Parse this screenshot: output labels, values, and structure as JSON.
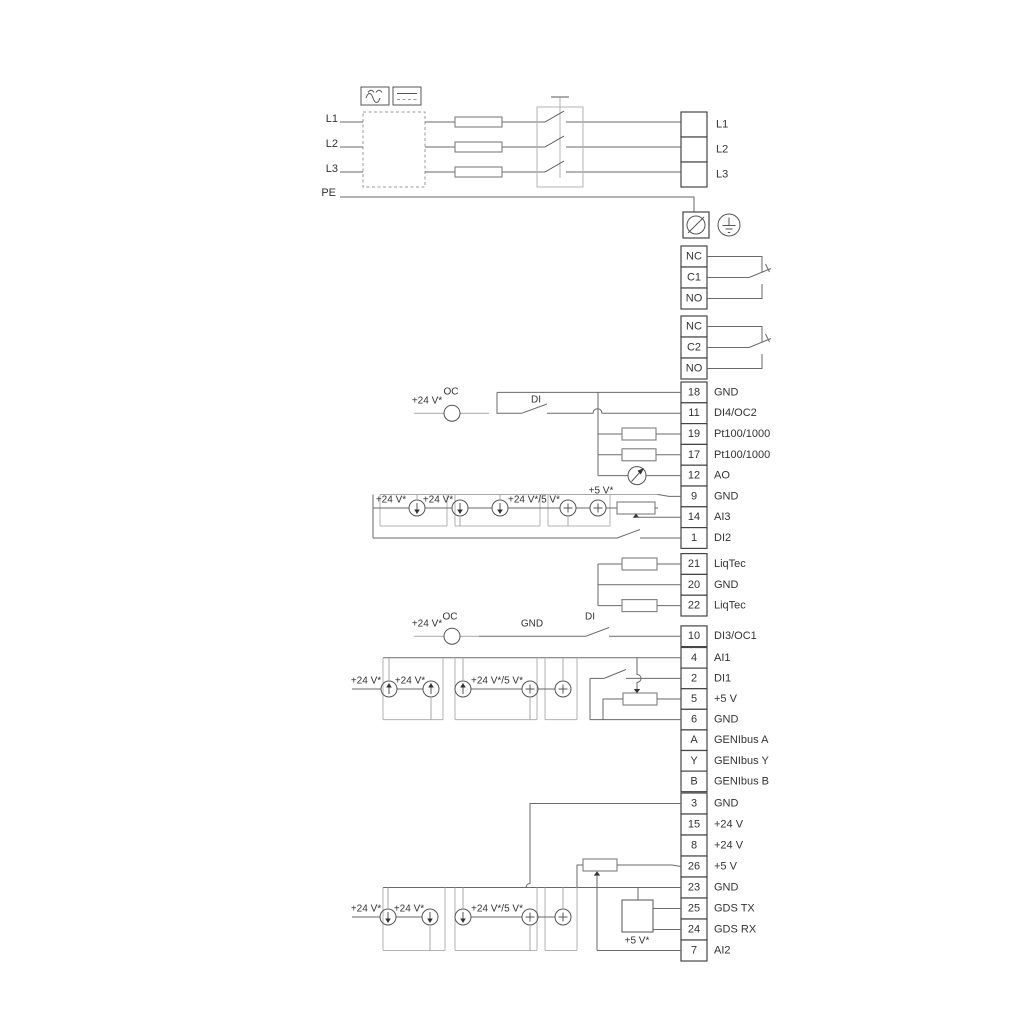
{
  "power": {
    "in": [
      "L1",
      "L2",
      "L3"
    ],
    "pe": "PE",
    "out": [
      "L1",
      "L2",
      "L3"
    ]
  },
  "relays": {
    "r1": [
      "NC",
      "C1",
      "NO"
    ],
    "r2": [
      "NC",
      "C2",
      "NO"
    ]
  },
  "terminals": {
    "io1": [
      {
        "n": "18",
        "l": "GND"
      },
      {
        "n": "11",
        "l": "DI4/OC2"
      },
      {
        "n": "19",
        "l": "Pt100/1000"
      },
      {
        "n": "17",
        "l": "Pt100/1000"
      },
      {
        "n": "12",
        "l": "AO"
      },
      {
        "n": "9",
        "l": "GND"
      },
      {
        "n": "14",
        "l": "AI3"
      },
      {
        "n": "1",
        "l": "DI2"
      }
    ],
    "liqtec": [
      {
        "n": "21",
        "l": "LiqTec"
      },
      {
        "n": "20",
        "l": "GND"
      },
      {
        "n": "22",
        "l": "LiqTec"
      }
    ],
    "di3": {
      "n": "10",
      "l": "DI3/OC1"
    },
    "io3": [
      {
        "n": "4",
        "l": "AI1"
      },
      {
        "n": "2",
        "l": "DI1"
      },
      {
        "n": "5",
        "l": "+5 V"
      },
      {
        "n": "6",
        "l": "GND"
      },
      {
        "n": "A",
        "l": "GENIbus A"
      },
      {
        "n": "Y",
        "l": "GENIbus Y"
      },
      {
        "n": "B",
        "l": "GENIbus B"
      }
    ],
    "io4": [
      {
        "n": "3",
        "l": "GND"
      },
      {
        "n": "15",
        "l": "+24 V"
      },
      {
        "n": "8",
        "l": "+24 V"
      },
      {
        "n": "26",
        "l": "+5 V"
      },
      {
        "n": "23",
        "l": "GND"
      },
      {
        "n": "25",
        "l": "GDS TX"
      },
      {
        "n": "24",
        "l": "GDS RX"
      },
      {
        "n": "7",
        "l": "AI2"
      }
    ]
  },
  "ann": {
    "v24": "+24 V*",
    "v24_5": "+24 V*/5 V*",
    "v5": "+5 V*",
    "oc": "OC",
    "di": "DI",
    "gnd": "GND"
  }
}
